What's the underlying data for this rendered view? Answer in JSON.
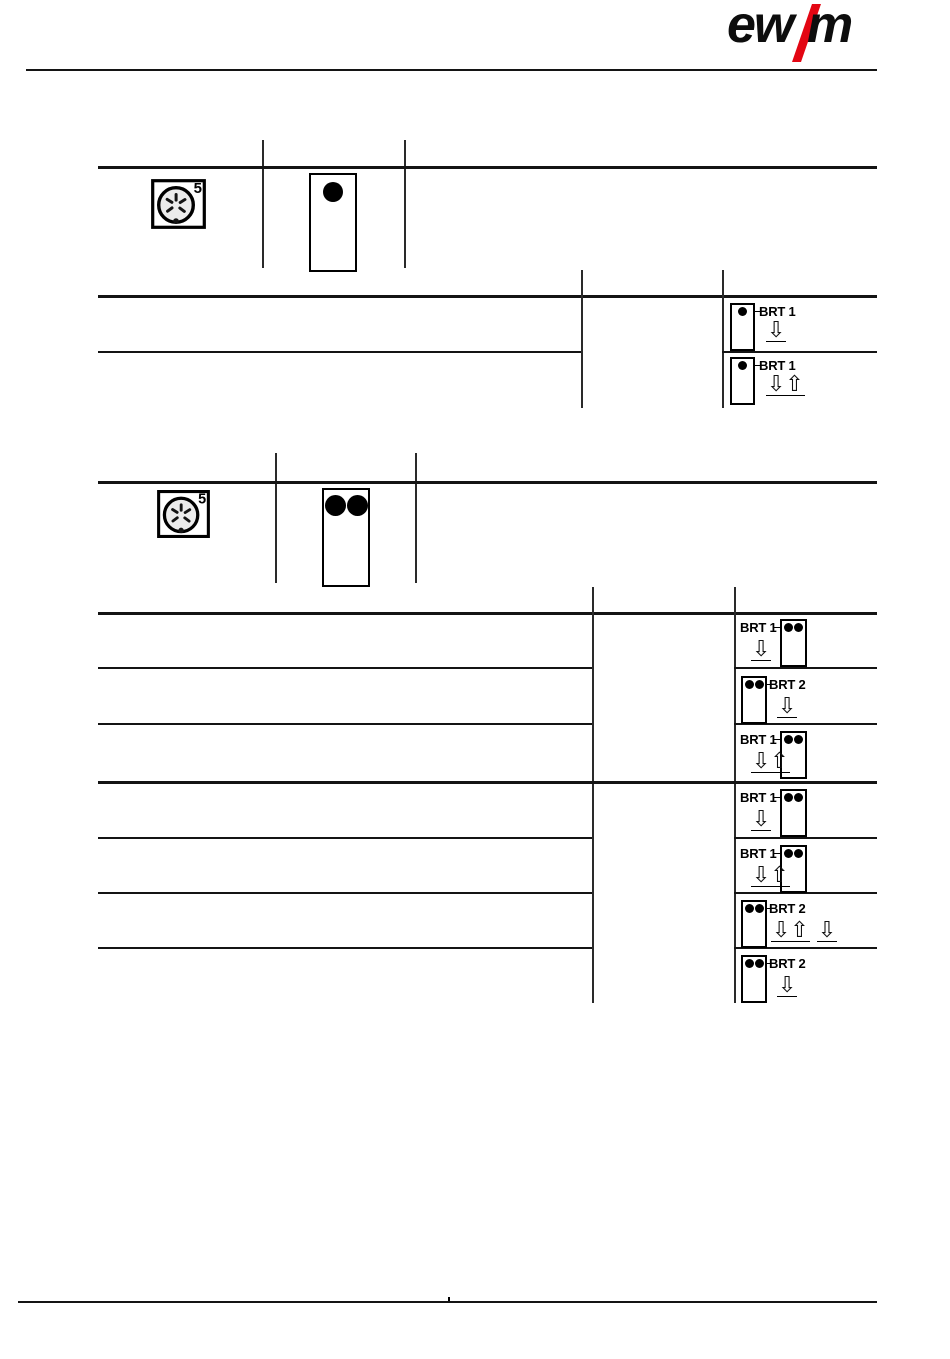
{
  "header": {
    "logo": {
      "left": "ew",
      "right": "m",
      "slash_color": "#e30613"
    }
  },
  "section_single_dot": {
    "connector_pin_label": "5",
    "panel": {
      "dot_count": 1
    },
    "rows": [
      {
        "label": "BRT 1",
        "arrows": [
          "⇩"
        ]
      },
      {
        "label": "BRT 1",
        "arrows": [
          "⇩⇧"
        ]
      }
    ]
  },
  "section_double_dot": {
    "connector_pin_label": "5",
    "panel": {
      "dot_count": 2
    },
    "group1": [
      {
        "label": "BRT 1",
        "arrows": [
          "⇩"
        ]
      },
      {
        "label": "BRT 2",
        "arrows": [
          "⇩"
        ]
      },
      {
        "label": "BRT 1",
        "arrows": [
          "⇩⇧"
        ]
      }
    ],
    "group2": [
      {
        "label": "BRT 1",
        "arrows": [
          "⇩"
        ]
      },
      {
        "label": "BRT 1",
        "arrows": [
          "⇩⇧"
        ]
      },
      {
        "label": "BRT 2",
        "arrows": [
          "⇩⇧",
          "⇩"
        ]
      },
      {
        "label": "BRT 2",
        "arrows": [
          "⇩"
        ]
      }
    ]
  }
}
